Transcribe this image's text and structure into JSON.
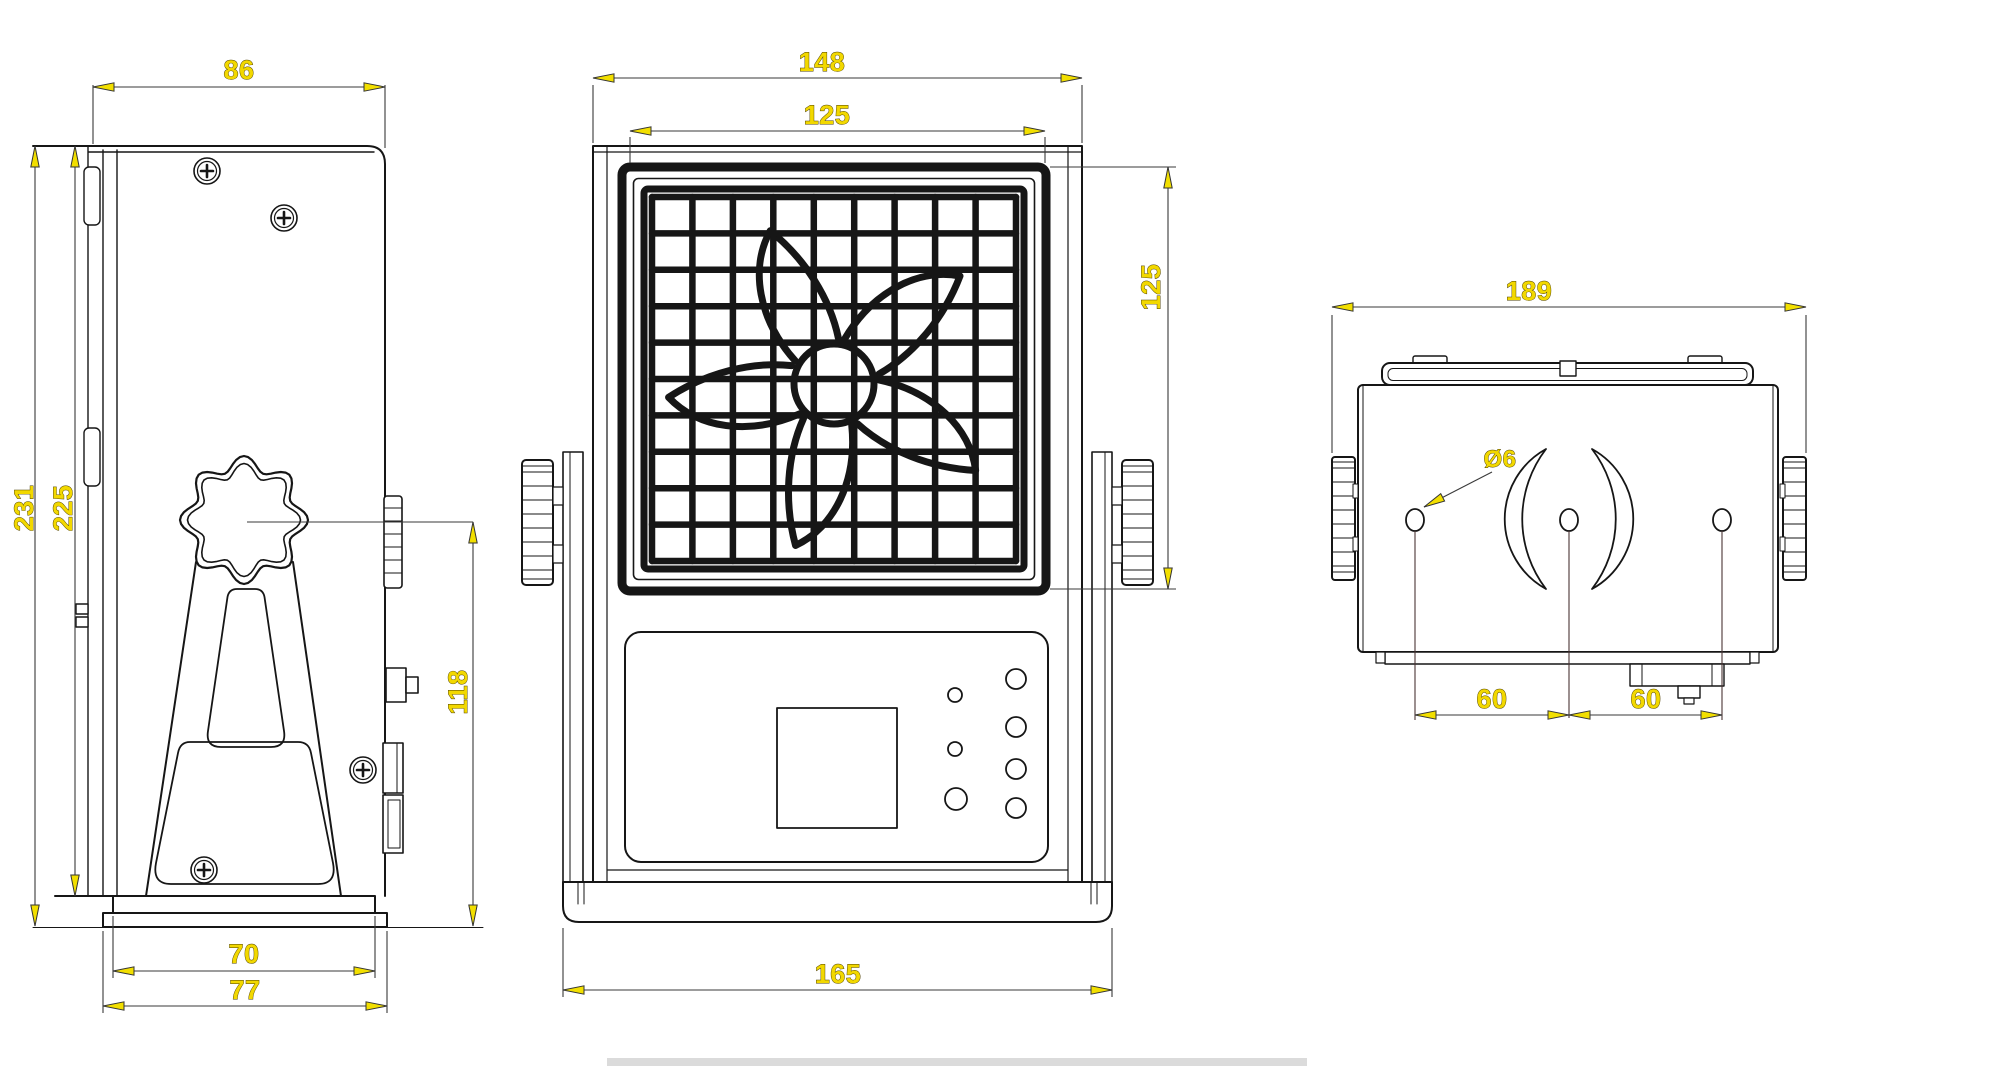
{
  "colors": {
    "paper": "#ffffff",
    "ink": "#161616",
    "dim_line": "#3a3a3a",
    "dim_text": "#f2d800",
    "dim_text_outline": "#4a3c00",
    "arrow": "#f2df00",
    "hole_ref_line": "#4a3434",
    "artifact": "#cccccc"
  },
  "views": {
    "side": {
      "dims": {
        "top_width": "86",
        "overall_height": "231",
        "body_height": "225",
        "knob_center_to_base": "118",
        "foot_width": "70",
        "base_width": "77"
      }
    },
    "front": {
      "dims": {
        "overall_width": "148",
        "grille_width": "125",
        "grille_height": "125",
        "base_width": "165"
      }
    },
    "top": {
      "dims": {
        "overall_width": "189",
        "hole_diameter": "Ø6",
        "hole_spacing_left": "60",
        "hole_spacing_right": "60"
      }
    }
  }
}
